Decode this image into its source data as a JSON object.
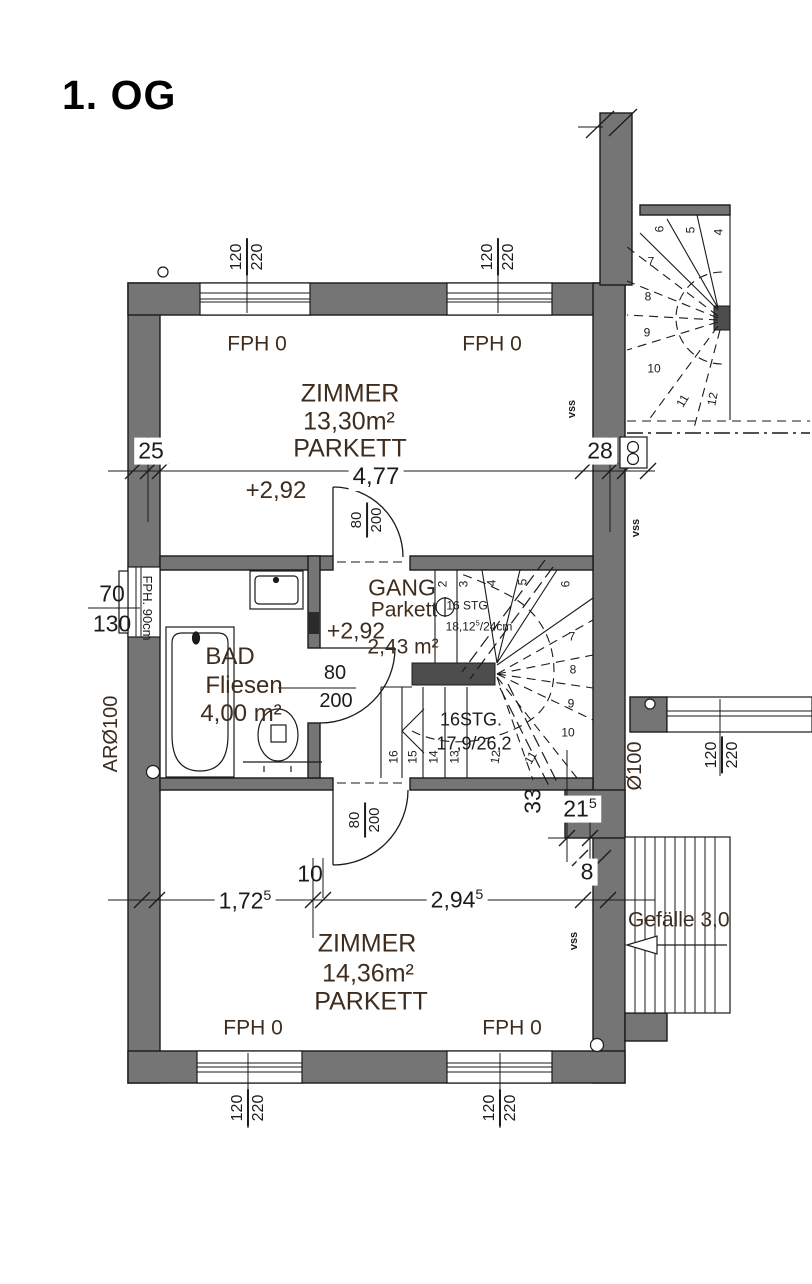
{
  "title": "1. OG",
  "rooms": {
    "zimmer1": {
      "name": "ZIMMER",
      "area": "13,30m²",
      "floor": "PARKETT",
      "level": "+2,92"
    },
    "zimmer2": {
      "name": "ZIMMER",
      "area": "14,36m²",
      "floor": "PARKETT"
    },
    "bad": {
      "name": "BAD",
      "floor": "Fliesen",
      "area": "4,00 m²"
    },
    "gang": {
      "name": "GANG",
      "floor": "Parkett",
      "level": "+2,92",
      "area": "2,43 m²"
    }
  },
  "windows": {
    "top_left": {
      "w": "120",
      "h": "220"
    },
    "top_right": {
      "w": "120",
      "h": "220"
    },
    "bottom_left": {
      "w": "120",
      "h": "220"
    },
    "bottom_right": {
      "w": "120",
      "h": "220"
    },
    "left": {
      "w": "70",
      "h": "130"
    },
    "left_note": "FPH. 90cm",
    "neighbor": {
      "w": "120",
      "h": "220"
    }
  },
  "doors": {
    "zimmer1": {
      "w": "80",
      "h": "200"
    },
    "bad": {
      "w": "80",
      "h": "200"
    },
    "zimmer2": {
      "w": "80",
      "h": "200"
    }
  },
  "stair_main": {
    "count_label": "16 STG",
    "riser": {
      "v": "18,12",
      "sup": "5",
      "rest": "/24cm"
    },
    "count_label2": "16STG.",
    "riser_label2": "17,9/26,2",
    "numbers": [
      "2",
      "3",
      "4",
      "5",
      "6",
      "7",
      "8",
      "9",
      "10",
      "11",
      "12",
      "13",
      "14",
      "15",
      "16"
    ]
  },
  "stair_outside": {
    "numbers": [
      "4",
      "5",
      "6",
      "7",
      "8",
      "9",
      "10",
      "11",
      "12"
    ]
  },
  "dimensions": {
    "room_width": "4,77",
    "wall_left": "25",
    "wall_right": "28",
    "seg1": {
      "v": "1,72",
      "sup": "5"
    },
    "nib": "10",
    "seg2": {
      "v": "2,94",
      "sup": "5"
    },
    "end": "8",
    "niche_h": "33",
    "niche_w": {
      "v": "21",
      "sup": "5"
    }
  },
  "annotations": {
    "fph0": "FPH 0",
    "vss": "vss",
    "ar_pipe": "ARØ100",
    "pipe": "Ø100",
    "slope": "Gefälle 3,0"
  },
  "colors": {
    "wall": "#757575",
    "wall_dark": "#4d4d4d",
    "line": "#1a1a1a",
    "room_text": "#3e2d1e"
  }
}
